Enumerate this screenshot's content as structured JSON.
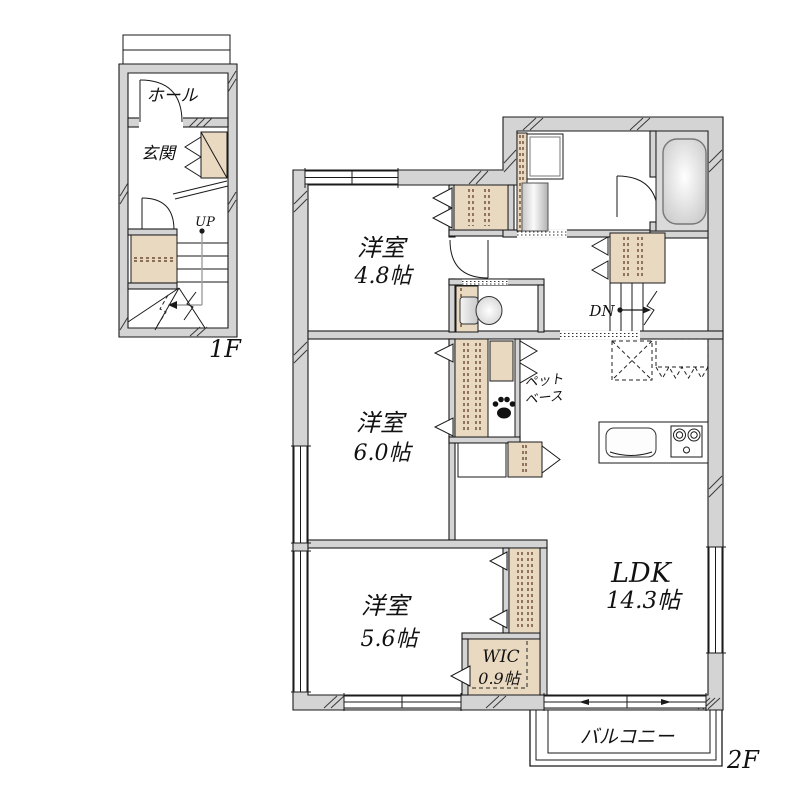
{
  "colors": {
    "wall": "#d4d4d4",
    "closet": "#ead9c1",
    "bath_floor": "#dadada",
    "dash_brown": "#6b4a35",
    "line": "#1a1a1a",
    "stair_path": "#a0a0a0"
  },
  "floor1": {
    "label": "1F",
    "hall_label": "ホール",
    "entrance_label": "玄関",
    "stairs_label": "UP"
  },
  "floor2": {
    "label": "2F",
    "stairs_label": "DN",
    "bedroom1": {
      "name": "洋室",
      "size": "4.8帖"
    },
    "bedroom2": {
      "name": "洋室",
      "size": "6.0帖"
    },
    "bedroom3": {
      "name": "洋室",
      "size": "5.6帖"
    },
    "ldk": {
      "name": "LDK",
      "size": "14.3帖"
    },
    "wic": {
      "name": "WIC",
      "size": "0.9帖"
    },
    "pet_base": {
      "line1": "ペット",
      "line2": "ベース"
    },
    "balcony_label": "バルコニー"
  }
}
